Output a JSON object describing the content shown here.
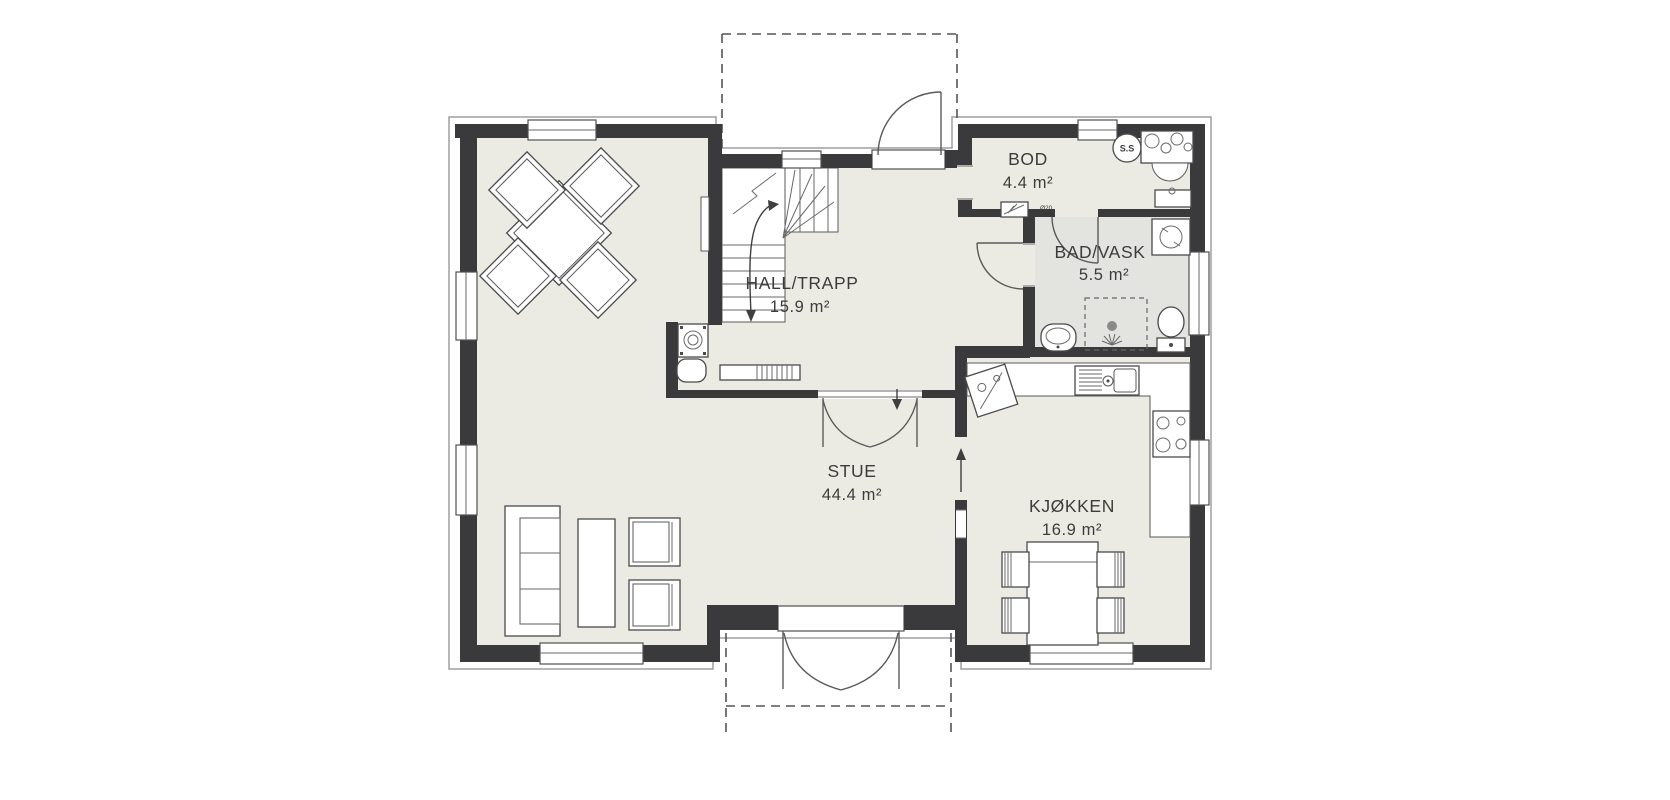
{
  "plan": {
    "rooms": [
      {
        "id": "bod",
        "name": "BOD",
        "area": "4.4 m²"
      },
      {
        "id": "bad-vask",
        "name": "BAD/VASK",
        "area": "5.5 m²"
      },
      {
        "id": "hall-trapp",
        "name": "HALL/TRAPP",
        "area": "15.9 m²"
      },
      {
        "id": "stue",
        "name": "STUE",
        "area": "44.4 m²"
      },
      {
        "id": "kjokken",
        "name": "KJØKKEN",
        "area": "16.9 m²"
      }
    ],
    "badges": {
      "ss": "S.S",
      "vent": "Ø20"
    },
    "colors": {
      "background": "#ffffff",
      "wall": "#3a3a3c",
      "floor_main": "#ECEBE3",
      "floor_bath": "#E3E3E0",
      "fixture_line": "#4a4a4a",
      "trim": "#9f9f9f"
    }
  }
}
